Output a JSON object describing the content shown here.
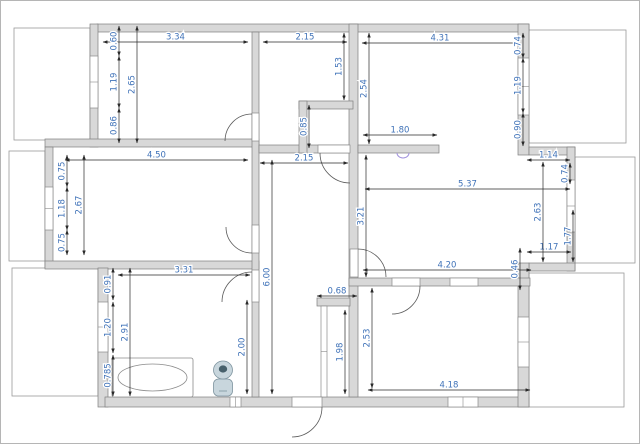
{
  "canvas": {
    "width": 640,
    "height": 444,
    "background": "#ffffff",
    "border_color": "#b5b5b5"
  },
  "colors": {
    "wall_fill": "#d8d8d8",
    "wall_stroke": "#7f7f7f",
    "opening_fill": "#ffffff",
    "opening_stroke": "#8a8a8a",
    "balcony_stroke": "#9a9a9a",
    "door_arc": "#5a5a5a",
    "dim_line": "#2a2a2a",
    "dim_text": "#3f72b8",
    "fixture_light": "#c8d6dd",
    "fixture_stroke": "#7d939e",
    "fixture_dark": "#47606b",
    "entry_marker": "#a293dd"
  },
  "walls": [
    {
      "x": 97,
      "y": 24,
      "w": 432,
      "h": 8
    },
    {
      "x": 90,
      "y": 24,
      "w": 8,
      "h": 123
    },
    {
      "x": 45,
      "y": 139,
      "w": 214,
      "h": 8
    },
    {
      "x": 45,
      "y": 147,
      "w": 8,
      "h": 121
    },
    {
      "x": 45,
      "y": 261,
      "w": 214,
      "h": 8
    },
    {
      "x": 98,
      "y": 268,
      "w": 10,
      "h": 139
    },
    {
      "x": 105,
      "y": 397,
      "w": 424,
      "h": 10
    },
    {
      "x": 518,
      "y": 24,
      "w": 11,
      "h": 131
    },
    {
      "x": 529,
      "y": 147,
      "w": 46,
      "h": 8
    },
    {
      "x": 567,
      "y": 147,
      "w": 8,
      "h": 124
    },
    {
      "x": 529,
      "y": 263,
      "w": 46,
      "h": 8
    },
    {
      "x": 518,
      "y": 263,
      "w": 11,
      "h": 144
    },
    {
      "x": 252,
      "y": 32,
      "w": 7,
      "h": 365
    },
    {
      "x": 349,
      "y": 24,
      "w": 9,
      "h": 373
    },
    {
      "x": 259,
      "y": 145,
      "w": 90,
      "h": 8
    },
    {
      "x": 358,
      "y": 145,
      "w": 81,
      "h": 8
    },
    {
      "x": 299,
      "y": 101,
      "w": 54,
      "h": 8
    },
    {
      "x": 299,
      "y": 101,
      "w": 8,
      "h": 52
    },
    {
      "x": 349,
      "y": 278,
      "w": 181,
      "h": 8
    },
    {
      "x": 317,
      "y": 298,
      "w": 33,
      "h": 8
    }
  ],
  "balconies": [
    {
      "x": 14,
      "y": 28,
      "w": 76,
      "h": 112
    },
    {
      "x": 529,
      "y": 30,
      "w": 97,
      "h": 113
    },
    {
      "x": 9,
      "y": 151,
      "w": 36,
      "h": 110
    },
    {
      "x": 12,
      "y": 268,
      "w": 86,
      "h": 128
    },
    {
      "x": 529,
      "y": 273,
      "w": 95,
      "h": 134
    },
    {
      "x": 575,
      "y": 157,
      "w": 60,
      "h": 106
    }
  ],
  "openings": [
    {
      "type": "window",
      "x": 90,
      "y": 56,
      "w": 8,
      "h": 52
    },
    {
      "type": "window",
      "x": 45,
      "y": 187,
      "w": 8,
      "h": 43
    },
    {
      "type": "window",
      "x": 98,
      "y": 302,
      "w": 10,
      "h": 50
    },
    {
      "type": "window",
      "x": 518,
      "y": 58,
      "w": 11,
      "h": 57
    },
    {
      "type": "window",
      "x": 567,
      "y": 180,
      "w": 8,
      "h": 52
    },
    {
      "type": "window",
      "x": 518,
      "y": 317,
      "w": 11,
      "h": 50
    },
    {
      "type": "window",
      "x": 448,
      "y": 397,
      "w": 30,
      "h": 10
    },
    {
      "type": "window",
      "x": 230,
      "y": 397,
      "w": 11,
      "h": 10
    },
    {
      "type": "cased-opening",
      "x": 450,
      "y": 278,
      "w": 28,
      "h": 8
    },
    {
      "type": "glass-partition",
      "x": 321,
      "y": 306,
      "w": 6,
      "h": 91
    },
    {
      "type": "door-opening",
      "x": 252,
      "y": 113,
      "w": 7,
      "h": 28
    },
    {
      "type": "door-opening",
      "x": 252,
      "y": 225,
      "w": 7,
      "h": 28
    },
    {
      "type": "door-opening",
      "x": 252,
      "y": 270,
      "w": 7,
      "h": 32
    },
    {
      "type": "door-opening",
      "x": 318,
      "y": 145,
      "w": 32,
      "h": 8
    },
    {
      "type": "door-opening",
      "x": 350,
      "y": 249,
      "w": 8,
      "h": 28
    },
    {
      "type": "door-opening",
      "x": 392,
      "y": 278,
      "w": 28,
      "h": 8
    },
    {
      "type": "door-opening",
      "x": 292,
      "y": 397,
      "w": 30,
      "h": 10
    }
  ],
  "door_arcs": [
    {
      "d": "M225,141 A27,27 0 0 1 252,114"
    },
    {
      "d": "M226,227 A26,26 0 0 0 252,253"
    },
    {
      "d": "M222,302 A30,30 0 0 1 252,272"
    },
    {
      "d": "M320,153 A30,30 0 0 0 350,183"
    },
    {
      "d": "M358,249 A28,28 0 0 1 386,277"
    },
    {
      "d": "M420,286 A28,28 0 0 1 392,314"
    },
    {
      "d": "M322,407 A30,30 0 0 1 292,437"
    }
  ],
  "dimensions": [
    {
      "label": "3.34",
      "x1": 103,
      "y1": 42,
      "x2": 248,
      "y2": 42,
      "orient": "h"
    },
    {
      "label": "2.15",
      "x1": 263,
      "y1": 42,
      "x2": 347,
      "y2": 42,
      "orient": "h"
    },
    {
      "label": "4.31",
      "x1": 362,
      "y1": 43,
      "x2": 518,
      "y2": 43,
      "orient": "h"
    },
    {
      "label": "4.50",
      "x1": 65,
      "y1": 160,
      "x2": 248,
      "y2": 160,
      "orient": "h"
    },
    {
      "label": "2.15",
      "x1": 260,
      "y1": 163,
      "x2": 348,
      "y2": 163,
      "orient": "h"
    },
    {
      "label": "1.80",
      "x1": 363,
      "y1": 135,
      "x2": 437,
      "y2": 135,
      "orient": "h"
    },
    {
      "label": "5.37",
      "x1": 365,
      "y1": 189,
      "x2": 570,
      "y2": 189,
      "orient": "h"
    },
    {
      "label": "1.14",
      "x1": 527,
      "y1": 160,
      "x2": 570,
      "y2": 160,
      "orient": "h"
    },
    {
      "label": "1.17",
      "x1": 527,
      "y1": 252,
      "x2": 571,
      "y2": 252,
      "orient": "h"
    },
    {
      "label": "3.31",
      "x1": 118,
      "y1": 275,
      "x2": 250,
      "y2": 275,
      "orient": "h"
    },
    {
      "label": "4.20",
      "x1": 363,
      "y1": 270,
      "x2": 531,
      "y2": 270,
      "orient": "h"
    },
    {
      "label": "0.68",
      "x1": 317,
      "y1": 296,
      "x2": 357,
      "y2": 296,
      "orient": "h"
    },
    {
      "label": "4.18",
      "x1": 368,
      "y1": 390,
      "x2": 530,
      "y2": 390,
      "orient": "h"
    },
    {
      "label": "0.60",
      "x1": 119,
      "y1": 26,
      "x2": 119,
      "y2": 56,
      "orient": "v"
    },
    {
      "label": "1.19",
      "x1": 119,
      "y1": 56,
      "x2": 119,
      "y2": 108,
      "orient": "v"
    },
    {
      "label": "0.86",
      "x1": 119,
      "y1": 108,
      "x2": 119,
      "y2": 143,
      "orient": "v"
    },
    {
      "label": "2.65",
      "x1": 137,
      "y1": 26,
      "x2": 137,
      "y2": 143,
      "orient": "v"
    },
    {
      "label": "0.75",
      "x1": 67,
      "y1": 155,
      "x2": 67,
      "y2": 187,
      "orient": "v"
    },
    {
      "label": "1.18",
      "x1": 67,
      "y1": 187,
      "x2": 67,
      "y2": 230,
      "orient": "v"
    },
    {
      "label": "0.75",
      "x1": 67,
      "y1": 230,
      "x2": 67,
      "y2": 255,
      "orient": "v"
    },
    {
      "label": "2.67",
      "x1": 84,
      "y1": 155,
      "x2": 84,
      "y2": 255,
      "orient": "v"
    },
    {
      "label": "0.91",
      "x1": 113,
      "y1": 268,
      "x2": 113,
      "y2": 300,
      "orient": "v"
    },
    {
      "label": "1.20",
      "x1": 113,
      "y1": 302,
      "x2": 113,
      "y2": 353,
      "orient": "v"
    },
    {
      "label": "0.785",
      "x1": 113,
      "y1": 355,
      "x2": 113,
      "y2": 396,
      "orient": "v"
    },
    {
      "label": "2.91",
      "x1": 130,
      "y1": 268,
      "x2": 130,
      "y2": 396,
      "orient": "v"
    },
    {
      "label": "2.00",
      "x1": 247,
      "y1": 300,
      "x2": 247,
      "y2": 394,
      "orient": "v"
    },
    {
      "label": "6.00",
      "x1": 272,
      "y1": 160,
      "x2": 272,
      "y2": 394,
      "orient": "v"
    },
    {
      "label": "1.53",
      "x1": 344,
      "y1": 33,
      "x2": 344,
      "y2": 100,
      "orient": "v"
    },
    {
      "label": "2.54",
      "x1": 369,
      "y1": 33,
      "x2": 369,
      "y2": 144,
      "orient": "v"
    },
    {
      "label": "0.85",
      "x1": 309,
      "y1": 105,
      "x2": 309,
      "y2": 148,
      "orient": "v"
    },
    {
      "label": "0.74",
      "x1": 523,
      "y1": 33,
      "x2": 523,
      "y2": 58,
      "orient": "v"
    },
    {
      "label": "1.19",
      "x1": 523,
      "y1": 58,
      "x2": 523,
      "y2": 113,
      "orient": "v"
    },
    {
      "label": "0.90",
      "x1": 523,
      "y1": 113,
      "x2": 523,
      "y2": 146,
      "orient": "v"
    },
    {
      "label": "0.74",
      "x1": 570,
      "y1": 163,
      "x2": 570,
      "y2": 184,
      "orient": "v"
    },
    {
      "label": "2.63",
      "x1": 543,
      "y1": 162,
      "x2": 543,
      "y2": 262,
      "orient": "v"
    },
    {
      "label": "1.77",
      "x1": 573,
      "y1": 210,
      "x2": 573,
      "y2": 262,
      "orient": "v"
    },
    {
      "label": "0.46",
      "x1": 520,
      "y1": 248,
      "x2": 520,
      "y2": 290,
      "orient": "v"
    },
    {
      "label": "3.21",
      "x1": 366,
      "y1": 155,
      "x2": 366,
      "y2": 277,
      "orient": "v"
    },
    {
      "label": "1.98",
      "x1": 345,
      "y1": 310,
      "x2": 345,
      "y2": 394,
      "orient": "v"
    },
    {
      "label": "2.53",
      "x1": 372,
      "y1": 288,
      "x2": 372,
      "y2": 388,
      "orient": "v"
    }
  ],
  "fixtures": [
    {
      "type": "bathtub",
      "x": 112,
      "y": 358,
      "w": 81,
      "h": 39
    },
    {
      "type": "toilet",
      "x": 223,
      "y": 370
    },
    {
      "type": "entry-marker",
      "x": 403,
      "y": 153
    }
  ]
}
